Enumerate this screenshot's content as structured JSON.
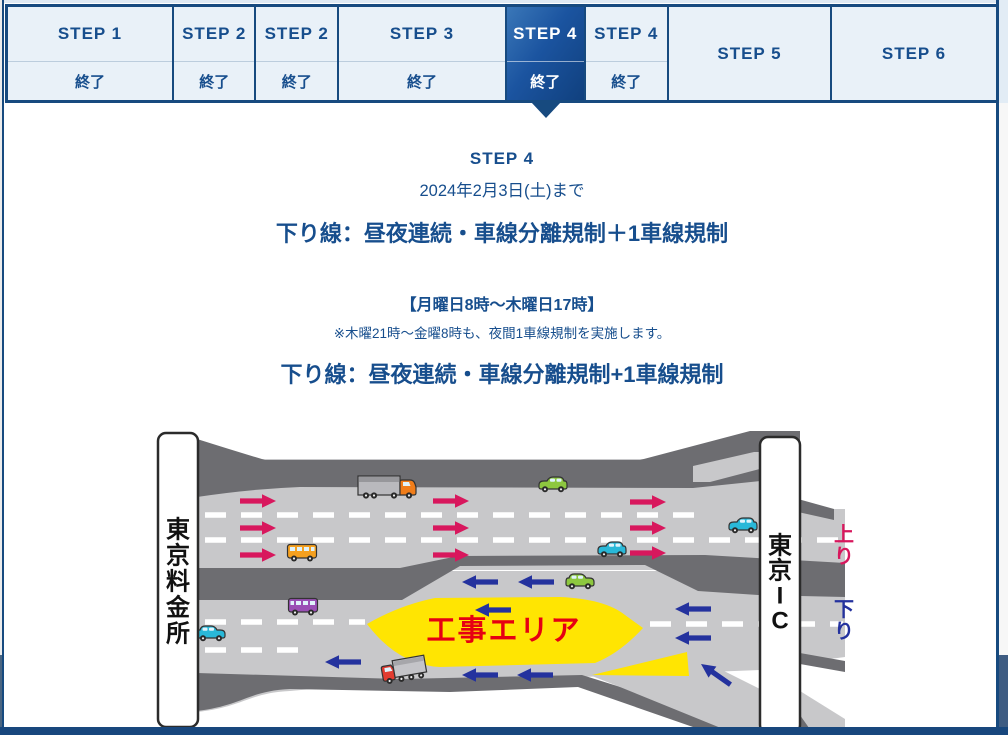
{
  "steps": {
    "columns": [
      {
        "label": "STEP 1",
        "status": "終了",
        "selected": false
      },
      {
        "label": "STEP 2",
        "status": "終了",
        "selected": false
      },
      {
        "label": "STEP 2",
        "status": "終了",
        "selected": false
      },
      {
        "label": "STEP 3",
        "status": "終了",
        "selected": false
      },
      {
        "label": "STEP 4",
        "status": "終了",
        "selected": true
      },
      {
        "label": "STEP 4",
        "status": "終了",
        "selected": false
      },
      {
        "label": "STEP 5",
        "status": "",
        "selected": false
      },
      {
        "label": "STEP 6",
        "status": "",
        "selected": false
      }
    ]
  },
  "detail": {
    "step_title": "STEP 4",
    "period": "2024年2月3日(土)まで",
    "headline": "下り線：昼夜連続・車線分離規制＋1車線規制",
    "schedule": "【月曜日8時～木曜日17時】",
    "note": "※木曜21時～金曜8時も、夜間1車線規制を実施します。",
    "diagram_title": "下り線：昼夜連続・車線分離規制+1車線規制"
  },
  "diagram": {
    "left_sign": "東京料金所",
    "left_sign_chars": [
      "東",
      "京",
      "料",
      "金",
      "所"
    ],
    "right_sign": "東京IC",
    "right_sign_chars": [
      "東",
      "京",
      "I",
      "C"
    ],
    "up_line_label": "上り",
    "up_chars": [
      "上",
      "り"
    ],
    "down_line_label": "下り",
    "down_chars": [
      "下",
      "り"
    ],
    "work_area_label": "工事エリア",
    "colors": {
      "up_pink": "#d8175d",
      "down_blue": "#24329e",
      "work_area_yellow": "#ffe502",
      "work_area_text_red": "#e60012",
      "road_light": "#c8c8ca",
      "road_dark": "#6d6d71",
      "accent_navy": "#174a7f"
    }
  }
}
